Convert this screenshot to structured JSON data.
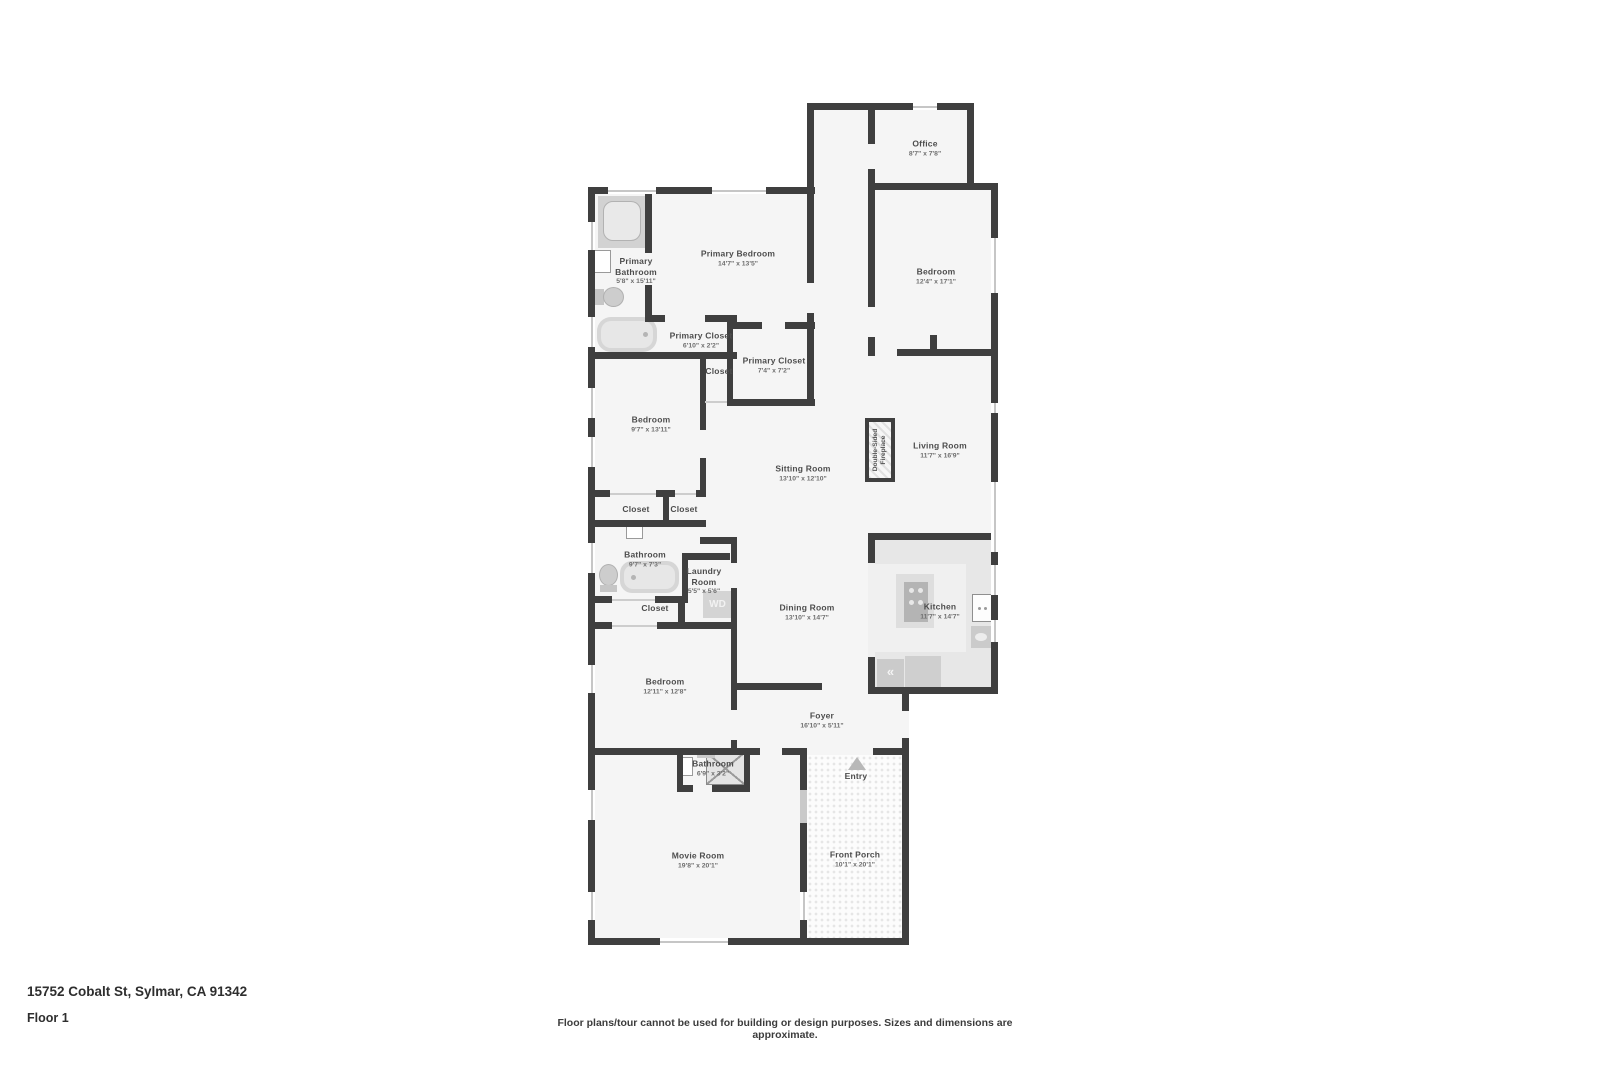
{
  "footer": {
    "address": "15752 Cobalt St, Sylmar, CA 91342",
    "floor_label": "Floor 1",
    "disclaimer": "Floor plans/tour cannot be used for building or design purposes. Sizes and dimensions are approximate."
  },
  "fireplace": {
    "label": "Double-Sided\nFireplace"
  },
  "appliances": {
    "washer_dryer": "WD",
    "fridge_glyph": "«"
  },
  "palette": {
    "wall": "#3f3f3f",
    "floor": "#f5f5f5",
    "fixture_gray": "#d6d6d6",
    "counter_gray": "#e7e7e7",
    "label_color": "#4d4d4d",
    "dims_color": "#6e6e6e"
  },
  "rooms": [
    {
      "id": "office",
      "name": "Office",
      "dims": "8'7\" x 7'8\"",
      "cx": 925,
      "cy": 148
    },
    {
      "id": "primary-bathroom",
      "name": "Primary\nBathroom",
      "dims": "5'8\" x 15'11\"",
      "cx": 636,
      "cy": 271
    },
    {
      "id": "primary-bedroom",
      "name": "Primary Bedroom",
      "dims": "14'7\" x 13'5\"",
      "cx": 738,
      "cy": 258
    },
    {
      "id": "bedroom-upper-right",
      "name": "Bedroom",
      "dims": "12'4\" x 17'1\"",
      "cx": 936,
      "cy": 276
    },
    {
      "id": "primary-closet-hall",
      "name": "Primary Closet",
      "dims": "6'10\" x 2'2\"",
      "cx": 701,
      "cy": 340
    },
    {
      "id": "primary-closet-main",
      "name": "Primary Closet",
      "dims": "7'4\" x 7'2\"",
      "cx": 774,
      "cy": 365
    },
    {
      "id": "closet-hall",
      "name": "Closet",
      "dims": "",
      "cx": 719,
      "cy": 371
    },
    {
      "id": "bedroom-left",
      "name": "Bedroom",
      "dims": "9'7\" x 13'11\"",
      "cx": 651,
      "cy": 424
    },
    {
      "id": "sitting-room",
      "name": "Sitting Room",
      "dims": "13'10\" x 12'10\"",
      "cx": 803,
      "cy": 473
    },
    {
      "id": "living-room",
      "name": "Living Room",
      "dims": "11'7\" x 16'9\"",
      "cx": 940,
      "cy": 450
    },
    {
      "id": "closet-left-a",
      "name": "Closet",
      "dims": "",
      "cx": 636,
      "cy": 509
    },
    {
      "id": "closet-left-b",
      "name": "Closet",
      "dims": "",
      "cx": 684,
      "cy": 509
    },
    {
      "id": "bathroom-left",
      "name": "Bathroom",
      "dims": "9'7\" x 7'3\"",
      "cx": 645,
      "cy": 559
    },
    {
      "id": "laundry-room",
      "name": "Laundry\nRoom",
      "dims": "5'5\" x 5'6\"",
      "cx": 704,
      "cy": 581
    },
    {
      "id": "closet-linen",
      "name": "Closet",
      "dims": "",
      "cx": 655,
      "cy": 608
    },
    {
      "id": "dining-room",
      "name": "Dining Room",
      "dims": "13'10\" x 14'7\"",
      "cx": 807,
      "cy": 612
    },
    {
      "id": "kitchen",
      "name": "Kitchen",
      "dims": "11'7\" x 14'7\"",
      "cx": 940,
      "cy": 611
    },
    {
      "id": "bedroom-lower",
      "name": "Bedroom",
      "dims": "12'11\" x 12'8\"",
      "cx": 665,
      "cy": 686
    },
    {
      "id": "foyer",
      "name": "Foyer",
      "dims": "16'10\" x 5'11\"",
      "cx": 822,
      "cy": 720
    },
    {
      "id": "bathroom-lower",
      "name": "Bathroom",
      "dims": "6'9\" x 3'2\"",
      "cx": 713,
      "cy": 768
    },
    {
      "id": "entry",
      "name": "Entry",
      "dims": "",
      "cx": 856,
      "cy": 776
    },
    {
      "id": "movie-room",
      "name": "Movie Room",
      "dims": "19'8\" x 20'1\"",
      "cx": 698,
      "cy": 860
    },
    {
      "id": "front-porch",
      "name": "Front Porch",
      "dims": "10'1\" x 20'1\"",
      "cx": 855,
      "cy": 859
    }
  ]
}
